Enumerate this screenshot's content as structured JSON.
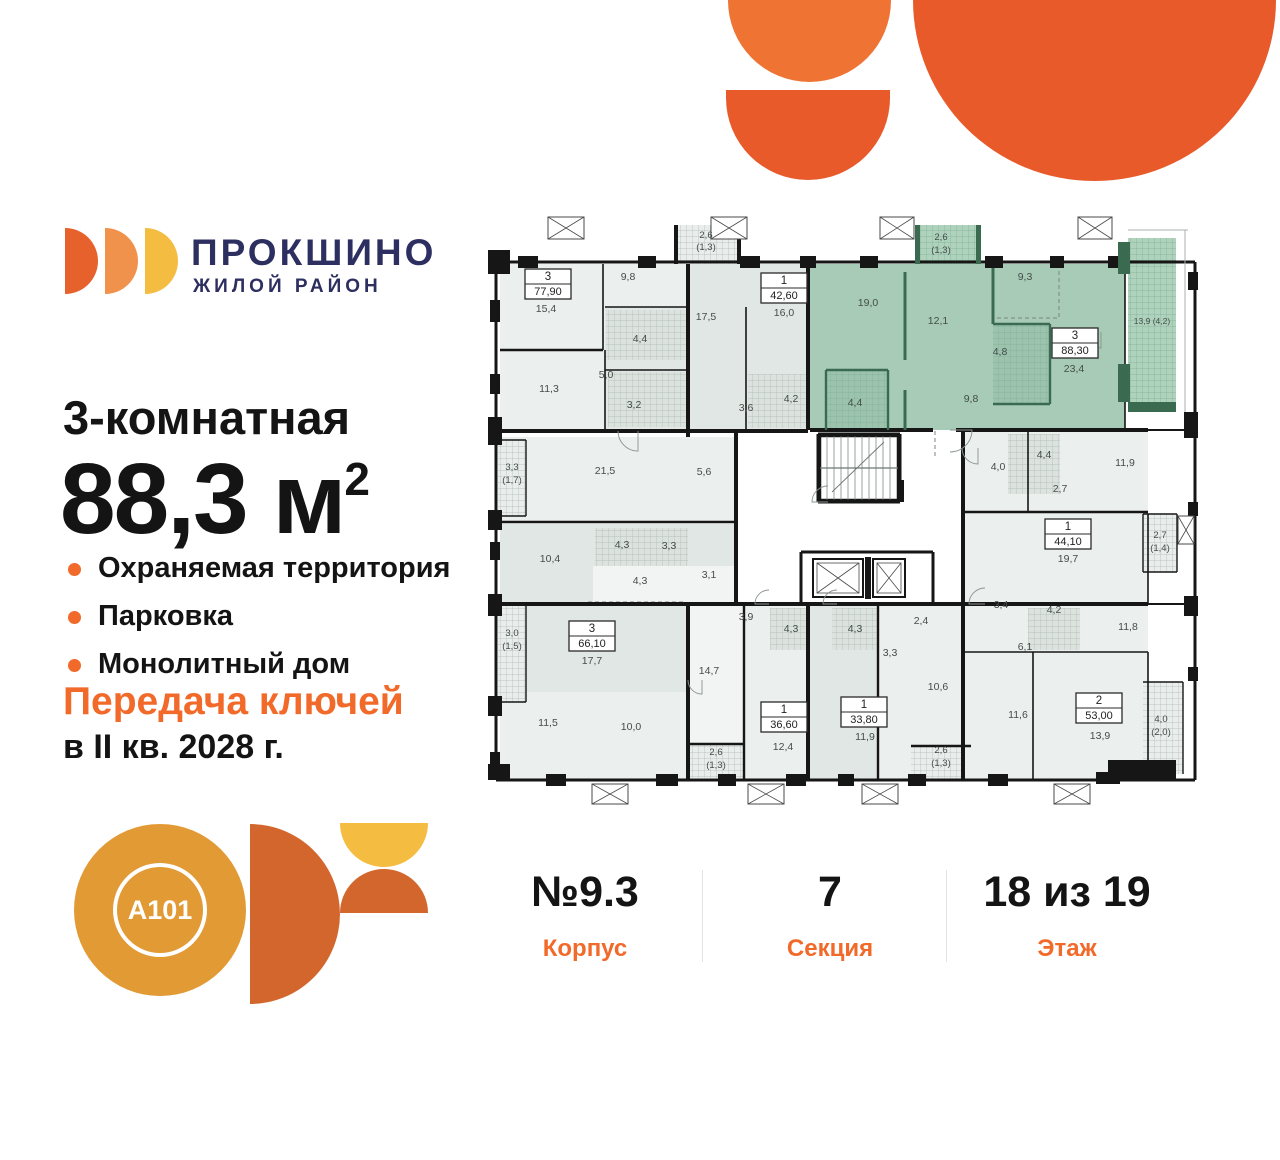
{
  "brand": {
    "name": "ПРОКШИНО",
    "tagline": "ЖИЛОЙ РАЙОН"
  },
  "listing": {
    "title": "3-комнатная",
    "area_value": "88,3",
    "area_unit": "м",
    "area_sup": "2",
    "features": [
      "Охраняемая территория",
      "Парковка",
      "Монолитный дом"
    ],
    "handover_line1": "Передача ключей",
    "handover_line2": "в II кв. 2028 г."
  },
  "developer": {
    "logo_text": "A101"
  },
  "stats": {
    "items": [
      {
        "value": "№9.3",
        "label": "Корпус"
      },
      {
        "value": "7",
        "label": "Секция"
      },
      {
        "value": "18 из 19",
        "label": "Этаж"
      }
    ]
  },
  "colors": {
    "accent_orange": "#F26A2A",
    "decor_orange": "#E95A2B",
    "decor_orange_light": "#EF7433",
    "navy": "#2D2F60",
    "petal1": "#E7612D",
    "petal2": "#F0914C",
    "petal3": "#F4BC40",
    "a101_circle": "#E29A34",
    "a101_half": "#D3662C",
    "highlight_green": "#A7CBB6"
  },
  "floorplan": {
    "palette": {
      "white": "#FFFFFF",
      "room1": "#EBEFED",
      "room2": "#E1E7E4",
      "room3": "#F1F4F2",
      "tile": "#DCE3DF",
      "green": "#A7CBB6",
      "greenB": "#AFD2BD",
      "tileG": "#9CC3AD",
      "grayB": "#E9EDEB",
      "dark": "#3A6B51",
      "wall": "#161616",
      "rail": "#A8B0AC",
      "line": "#8A9490",
      "label": "#454D49",
      "dash": "#7C8681"
    },
    "fills": [
      [
        8,
        50,
        699,
        518,
        "white",
        0
      ],
      [
        12,
        52,
        188,
        165,
        "room1",
        0
      ],
      [
        117,
        95,
        83,
        122,
        "room2",
        0
      ],
      [
        118,
        98,
        80,
        50,
        "tile",
        1
      ],
      [
        120,
        160,
        78,
        55,
        "tile",
        1
      ],
      [
        200,
        52,
        120,
        166,
        "room2",
        0
      ],
      [
        260,
        162,
        58,
        54,
        "tile",
        1
      ],
      [
        322,
        52,
        315,
        166,
        "green",
        0
      ],
      [
        640,
        26,
        48,
        174,
        "greenB",
        2
      ],
      [
        427,
        13,
        66,
        39,
        "greenB",
        2
      ],
      [
        186,
        13,
        67,
        39,
        "grayB",
        1
      ],
      [
        12,
        225,
        236,
        85,
        "room1",
        0
      ],
      [
        10,
        228,
        28,
        76,
        "grayB",
        1
      ],
      [
        12,
        312,
        236,
        80,
        "room2",
        0
      ],
      [
        107,
        316,
        93,
        38,
        "tile",
        1
      ],
      [
        105,
        354,
        143,
        36,
        "room3",
        0
      ],
      [
        12,
        392,
        188,
        176,
        "room2",
        0
      ],
      [
        12,
        480,
        188,
        86,
        "room1",
        0
      ],
      [
        10,
        392,
        28,
        98,
        "grayB",
        1
      ],
      [
        200,
        392,
        56,
        140,
        "room3",
        0
      ],
      [
        200,
        532,
        56,
        34,
        "grayB",
        1
      ],
      [
        256,
        392,
        64,
        176,
        "room1",
        0
      ],
      [
        282,
        396,
        56,
        42,
        "tile",
        1
      ],
      [
        320,
        392,
        70,
        176,
        "room2",
        0
      ],
      [
        344,
        396,
        50,
        42,
        "tile",
        1
      ],
      [
        390,
        392,
        85,
        176,
        "room1",
        0
      ],
      [
        423,
        534,
        60,
        33,
        "grayB",
        1
      ],
      [
        475,
        218,
        185,
        174,
        "room1",
        0
      ],
      [
        520,
        222,
        52,
        60,
        "tile",
        1
      ],
      [
        655,
        302,
        34,
        58,
        "grayB",
        1
      ],
      [
        475,
        392,
        185,
        176,
        "room1",
        0
      ],
      [
        540,
        396,
        52,
        42,
        "tile",
        1
      ],
      [
        655,
        470,
        40,
        92,
        "grayB",
        1
      ],
      [
        338,
        158,
        62,
        60,
        "tileG",
        2
      ],
      [
        505,
        112,
        57,
        80,
        "tileG",
        2
      ]
    ],
    "dashed": [
      [
        571,
        52,
        571,
        106
      ],
      [
        509,
        106,
        571,
        106
      ],
      [
        100,
        390,
        198,
        390
      ],
      [
        447,
        219,
        447,
        245
      ]
    ],
    "walls": [
      [
        8,
        50,
        707,
        50,
        3
      ],
      [
        707,
        50,
        707,
        568,
        3
      ],
      [
        8,
        568,
        707,
        568,
        3
      ],
      [
        8,
        50,
        8,
        568,
        3
      ],
      [
        200,
        52,
        200,
        225,
        4
      ],
      [
        320,
        52,
        320,
        218,
        4
      ],
      [
        115,
        52,
        115,
        138,
        1.6
      ],
      [
        12,
        138,
        115,
        138,
        2.4
      ],
      [
        117,
        95,
        200,
        95,
        1.6
      ],
      [
        117,
        138,
        117,
        218,
        1.6
      ],
      [
        117,
        158,
        200,
        158,
        1.6
      ],
      [
        8,
        219,
        320,
        219,
        4
      ],
      [
        322,
        218,
        445,
        218,
        4
      ],
      [
        468,
        218,
        660,
        218,
        4
      ],
      [
        660,
        218,
        707,
        218,
        2
      ],
      [
        248,
        219,
        248,
        392,
        4
      ],
      [
        8,
        310,
        248,
        310,
        2.4
      ],
      [
        8,
        392,
        475,
        392,
        4
      ],
      [
        475,
        392,
        660,
        392,
        4
      ],
      [
        660,
        392,
        707,
        392,
        2
      ],
      [
        200,
        392,
        200,
        568,
        4
      ],
      [
        256,
        392,
        256,
        568,
        2.4
      ],
      [
        320,
        392,
        320,
        568,
        4
      ],
      [
        390,
        392,
        390,
        568,
        2.4
      ],
      [
        475,
        218,
        475,
        568,
        4
      ],
      [
        545,
        440,
        545,
        568,
        1.6
      ],
      [
        475,
        440,
        660,
        440,
        1.6
      ],
      [
        540,
        218,
        540,
        300,
        1.6
      ],
      [
        475,
        300,
        660,
        300,
        2.4
      ],
      [
        660,
        302,
        660,
        392,
        1.6
      ],
      [
        660,
        440,
        660,
        568,
        1.6
      ],
      [
        637,
        52,
        637,
        218,
        1.6
      ],
      [
        258,
        95,
        258,
        218,
        1.6
      ],
      [
        200,
        532,
        256,
        532,
        2.4
      ],
      [
        423,
        534,
        483,
        534,
        2.4
      ],
      [
        330,
        222,
        412,
        222,
        3
      ],
      [
        330,
        222,
        330,
        290,
        3
      ],
      [
        412,
        222,
        412,
        290,
        3
      ],
      [
        330,
        290,
        412,
        290,
        3
      ],
      [
        313,
        340,
        445,
        340,
        3
      ],
      [
        313,
        340,
        313,
        392,
        3
      ],
      [
        445,
        340,
        445,
        392,
        3
      ],
      [
        640,
        18,
        700,
        18,
        1,
        "rail"
      ],
      [
        697,
        18,
        697,
        200,
        1,
        "rail"
      ],
      [
        10,
        228,
        38,
        228,
        1.4
      ],
      [
        38,
        228,
        38,
        304,
        1.4
      ],
      [
        10,
        304,
        38,
        304,
        1.4
      ],
      [
        10,
        392,
        38,
        392,
        1.4
      ],
      [
        38,
        392,
        38,
        490,
        1.4
      ],
      [
        10,
        490,
        38,
        490,
        1.4
      ],
      [
        655,
        302,
        655,
        360,
        1.4
      ],
      [
        655,
        302,
        689,
        302,
        1.4
      ],
      [
        655,
        360,
        689,
        360,
        1.4
      ],
      [
        689,
        302,
        689,
        360,
        1.4
      ],
      [
        655,
        470,
        695,
        470,
        1.4
      ],
      [
        695,
        470,
        695,
        562,
        1.4
      ],
      [
        417,
        60,
        417,
        148,
        3,
        "dark"
      ],
      [
        417,
        178,
        417,
        218,
        3,
        "dark"
      ],
      [
        505,
        52,
        505,
        112,
        3,
        "dark"
      ],
      [
        338,
        158,
        400,
        158,
        2.4,
        "dark"
      ],
      [
        338,
        158,
        338,
        218,
        2.4,
        "dark"
      ],
      [
        400,
        158,
        400,
        218,
        2.4,
        "dark"
      ],
      [
        505,
        112,
        562,
        112,
        2.4,
        "dark"
      ],
      [
        562,
        112,
        562,
        192,
        2.4,
        "dark"
      ],
      [
        505,
        192,
        562,
        192,
        2.4,
        "dark"
      ]
    ],
    "rects": [
      [
        0,
        38,
        22,
        24
      ],
      [
        30,
        44,
        20,
        12
      ],
      [
        150,
        44,
        18,
        12
      ],
      [
        252,
        44,
        20,
        12
      ],
      [
        312,
        44,
        16,
        12
      ],
      [
        372,
        44,
        18,
        12
      ],
      [
        497,
        44,
        18,
        12
      ],
      [
        562,
        44,
        14,
        12
      ],
      [
        620,
        44,
        17,
        12
      ],
      [
        2,
        88,
        10,
        22
      ],
      [
        2,
        162,
        10,
        20
      ],
      [
        0,
        205,
        14,
        28
      ],
      [
        0,
        298,
        14,
        20
      ],
      [
        2,
        330,
        10,
        18
      ],
      [
        0,
        382,
        14,
        22
      ],
      [
        0,
        484,
        14,
        20
      ],
      [
        2,
        540,
        10,
        18
      ],
      [
        0,
        552,
        22,
        16
      ],
      [
        58,
        562,
        20,
        12
      ],
      [
        168,
        562,
        22,
        12
      ],
      [
        230,
        562,
        18,
        12
      ],
      [
        298,
        562,
        20,
        12
      ],
      [
        350,
        562,
        16,
        12
      ],
      [
        420,
        562,
        18,
        12
      ],
      [
        500,
        562,
        20,
        12
      ],
      [
        608,
        560,
        24,
        12
      ],
      [
        620,
        548,
        68,
        20
      ],
      [
        700,
        60,
        10,
        18
      ],
      [
        696,
        200,
        14,
        26
      ],
      [
        700,
        290,
        10,
        14
      ],
      [
        696,
        384,
        14,
        20
      ],
      [
        700,
        455,
        10,
        14
      ],
      [
        630,
        30,
        12,
        32,
        "dark"
      ],
      [
        630,
        152,
        12,
        38,
        "dark"
      ],
      [
        640,
        190,
        48,
        10,
        "dark"
      ],
      [
        427,
        13,
        5,
        39,
        "dark"
      ],
      [
        488,
        13,
        5,
        39,
        "dark"
      ],
      [
        186,
        13,
        4,
        39
      ],
      [
        249,
        13,
        4,
        39
      ],
      [
        377,
        345,
        6,
        42
      ],
      [
        408,
        268,
        8,
        22
      ]
    ],
    "crosses": [
      [
        60,
        5,
        36,
        22
      ],
      [
        223,
        5,
        36,
        22
      ],
      [
        392,
        5,
        34,
        22
      ],
      [
        590,
        5,
        34,
        22
      ],
      [
        104,
        572,
        36,
        20
      ],
      [
        260,
        572,
        36,
        20
      ],
      [
        374,
        572,
        36,
        20
      ],
      [
        566,
        572,
        36,
        20
      ],
      [
        690,
        304,
        16,
        28
      ]
    ],
    "elevators": [
      [
        325,
        347,
        50,
        38
      ],
      [
        385,
        347,
        32,
        38
      ]
    ],
    "stairs": {
      "x": 332,
      "y": 224,
      "w": 78,
      "h": 64
    },
    "doors": [
      [
        150,
        219,
        20,
        90,
        180
      ],
      [
        462,
        218,
        22,
        0,
        90
      ],
      [
        340,
        290,
        16,
        180,
        270
      ],
      [
        490,
        236,
        16,
        90,
        180
      ],
      [
        497,
        392,
        16,
        180,
        270
      ],
      [
        281,
        392,
        14,
        180,
        270
      ],
      [
        349,
        392,
        14,
        180,
        270
      ],
      [
        214,
        468,
        14,
        90,
        180
      ],
      [
        613,
        120,
        16,
        90,
        180
      ]
    ],
    "labels": [
      [
        58,
        100,
        "15,4"
      ],
      [
        140,
        68,
        "9,8"
      ],
      [
        61,
        180,
        "11,3"
      ],
      [
        118,
        166,
        "5,0"
      ],
      [
        152,
        130,
        "4,4"
      ],
      [
        146,
        196,
        "3,2"
      ],
      [
        218,
        26,
        "2,6",
        9.5
      ],
      [
        218,
        38,
        "(1,3)",
        9.5
      ],
      [
        117,
        262,
        "21,5"
      ],
      [
        216,
        263,
        "5,6"
      ],
      [
        24,
        258,
        "3,3",
        9.5
      ],
      [
        24,
        271,
        "(1,7)",
        9.5
      ],
      [
        296,
        104,
        "16,0"
      ],
      [
        218,
        108,
        "17,5"
      ],
      [
        258,
        199,
        "3,6"
      ],
      [
        303,
        190,
        "4,2"
      ],
      [
        380,
        94,
        "19,0"
      ],
      [
        450,
        112,
        "12,1"
      ],
      [
        453,
        28,
        "2,6",
        9.5
      ],
      [
        453,
        41,
        "(1,3)",
        9.5
      ],
      [
        537,
        68,
        "9,3"
      ],
      [
        512,
        143,
        "4,8"
      ],
      [
        586,
        160,
        "23,4"
      ],
      [
        483,
        190,
        "9,8"
      ],
      [
        367,
        194,
        "4,4"
      ],
      [
        664,
        112,
        "13,9 (4,2)",
        8.5
      ],
      [
        62,
        350,
        "10,4"
      ],
      [
        134,
        336,
        "4,3"
      ],
      [
        181,
        337,
        "3,3"
      ],
      [
        152,
        372,
        "4,3"
      ],
      [
        221,
        366,
        "3,1"
      ],
      [
        24,
        424,
        "3,0",
        9.5
      ],
      [
        24,
        437,
        "(1,5)",
        9.5
      ],
      [
        104,
        452,
        "17,7"
      ],
      [
        60,
        514,
        "11,5"
      ],
      [
        143,
        518,
        "10,0"
      ],
      [
        221,
        462,
        "14,7"
      ],
      [
        258,
        408,
        "3,9"
      ],
      [
        303,
        420,
        "4,3"
      ],
      [
        295,
        538,
        "12,4"
      ],
      [
        228,
        543,
        "2,6",
        9.5
      ],
      [
        228,
        556,
        "(1,3)",
        9.5
      ],
      [
        367,
        420,
        "4,3"
      ],
      [
        402,
        444,
        "3,3"
      ],
      [
        433,
        412,
        "2,4"
      ],
      [
        450,
        478,
        "10,6"
      ],
      [
        377,
        528,
        "11,9"
      ],
      [
        453,
        541,
        "2,6",
        9.5
      ],
      [
        453,
        554,
        "(1,3)",
        9.5
      ],
      [
        513,
        396,
        "3,4"
      ],
      [
        566,
        401,
        "4,2"
      ],
      [
        537,
        438,
        "6,1"
      ],
      [
        640,
        418,
        "11,8"
      ],
      [
        530,
        506,
        "11,6"
      ],
      [
        612,
        527,
        "13,9"
      ],
      [
        673,
        510,
        "4,0",
        9.5
      ],
      [
        673,
        523,
        "(2,0)",
        9.5
      ],
      [
        510,
        258,
        "4,0"
      ],
      [
        556,
        246,
        "4,4"
      ],
      [
        637,
        254,
        "11,9"
      ],
      [
        572,
        280,
        "2,7"
      ],
      [
        580,
        350,
        "19,7"
      ],
      [
        672,
        326,
        "2,7",
        9.5
      ],
      [
        672,
        339,
        "(1,4)",
        9.5
      ]
    ],
    "unitboxes": [
      {
        "x": 60,
        "y": 72,
        "n": "3",
        "a": "77,90"
      },
      {
        "x": 296,
        "y": 76,
        "n": "1",
        "a": "42,60"
      },
      {
        "x": 587,
        "y": 131,
        "n": "3",
        "a": "88,30"
      },
      {
        "x": 104,
        "y": 424,
        "n": "3",
        "a": "66,10"
      },
      {
        "x": 296,
        "y": 505,
        "n": "1",
        "a": "36,60"
      },
      {
        "x": 376,
        "y": 500,
        "n": "1",
        "a": "33,80"
      },
      {
        "x": 611,
        "y": 496,
        "n": "2",
        "a": "53,00"
      },
      {
        "x": 580,
        "y": 322,
        "n": "1",
        "a": "44,10"
      }
    ]
  }
}
